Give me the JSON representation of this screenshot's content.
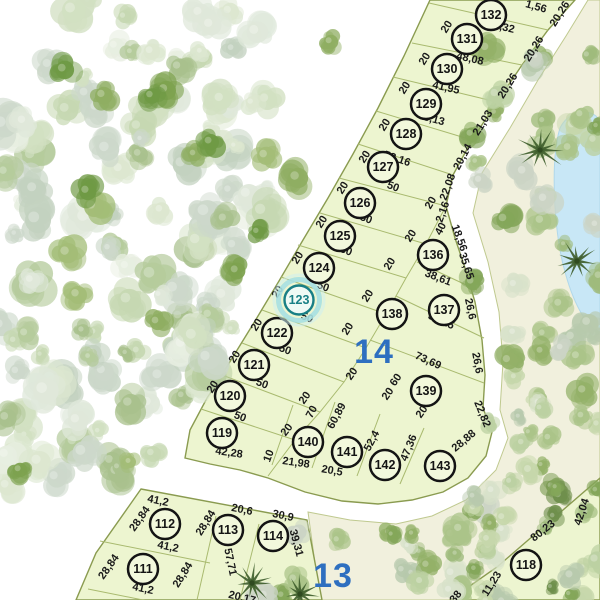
{
  "map": {
    "type": "subdivision-plan",
    "selected_lot": "123",
    "blocks": [
      {
        "label": "14",
        "x": 374,
        "y": 352
      },
      {
        "label": "13",
        "x": 333,
        "y": 576
      }
    ],
    "lots": [
      {
        "num": "111",
        "x": 143,
        "y": 569
      },
      {
        "num": "112",
        "x": 165,
        "y": 524
      },
      {
        "num": "113",
        "x": 228,
        "y": 530
      },
      {
        "num": "114",
        "x": 273,
        "y": 536
      },
      {
        "num": "118",
        "x": 526,
        "y": 565
      },
      {
        "num": "119",
        "x": 222,
        "y": 433
      },
      {
        "num": "120",
        "x": 230,
        "y": 396
      },
      {
        "num": "121",
        "x": 254,
        "y": 365
      },
      {
        "num": "122",
        "x": 277,
        "y": 333
      },
      {
        "num": "123",
        "x": 299,
        "y": 300,
        "selected": true
      },
      {
        "num": "124",
        "x": 319,
        "y": 268
      },
      {
        "num": "125",
        "x": 340,
        "y": 236
      },
      {
        "num": "126",
        "x": 360,
        "y": 203
      },
      {
        "num": "127",
        "x": 383,
        "y": 167
      },
      {
        "num": "128",
        "x": 406,
        "y": 134
      },
      {
        "num": "129",
        "x": 426,
        "y": 104
      },
      {
        "num": "130",
        "x": 447,
        "y": 69
      },
      {
        "num": "131",
        "x": 467,
        "y": 39
      },
      {
        "num": "132",
        "x": 491,
        "y": 15
      },
      {
        "num": "136",
        "x": 433,
        "y": 255
      },
      {
        "num": "137",
        "x": 444,
        "y": 310
      },
      {
        "num": "138",
        "x": 392,
        "y": 314
      },
      {
        "num": "139",
        "x": 426,
        "y": 391
      },
      {
        "num": "140",
        "x": 308,
        "y": 442
      },
      {
        "num": "141",
        "x": 347,
        "y": 452
      },
      {
        "num": "142",
        "x": 385,
        "y": 465
      },
      {
        "num": "143",
        "x": 440,
        "y": 466
      }
    ],
    "dimensions": [
      {
        "text": "1,56",
        "x": 536,
        "y": 7,
        "rot": 16
      },
      {
        "text": "51,32",
        "x": 501,
        "y": 27,
        "rot": 13
      },
      {
        "text": "48,08",
        "x": 470,
        "y": 59,
        "rot": 13
      },
      {
        "text": "41,95",
        "x": 446,
        "y": 88,
        "rot": 13
      },
      {
        "text": "43,13",
        "x": 431,
        "y": 119,
        "rot": 15
      },
      {
        "text": "52,16",
        "x": 397,
        "y": 159,
        "rot": 19
      },
      {
        "text": "50",
        "x": 393,
        "y": 187,
        "rot": 21
      },
      {
        "text": "50",
        "x": 366,
        "y": 219,
        "rot": 21
      },
      {
        "text": "50",
        "x": 346,
        "y": 251,
        "rot": 21
      },
      {
        "text": "50",
        "x": 323,
        "y": 287,
        "rot": 21
      },
      {
        "text": "50",
        "x": 307,
        "y": 318,
        "rot": 21
      },
      {
        "text": "50",
        "x": 285,
        "y": 350,
        "rot": 21
      },
      {
        "text": "50",
        "x": 262,
        "y": 384,
        "rot": 21
      },
      {
        "text": "50",
        "x": 240,
        "y": 417,
        "rot": 21
      },
      {
        "text": "42,28",
        "x": 229,
        "y": 453,
        "rot": 8
      },
      {
        "text": "20,26",
        "x": 560,
        "y": 14,
        "rot": -58
      },
      {
        "text": "20,26",
        "x": 534,
        "y": 49,
        "rot": -58
      },
      {
        "text": "20,26",
        "x": 508,
        "y": 86,
        "rot": -58
      },
      {
        "text": "21,03",
        "x": 483,
        "y": 123,
        "rot": -58
      },
      {
        "text": "20,14",
        "x": 463,
        "y": 157,
        "rot": -62
      },
      {
        "text": "22,08",
        "x": 448,
        "y": 187,
        "rot": -70
      },
      {
        "text": "2,16",
        "x": 443,
        "y": 212,
        "rot": -70
      },
      {
        "text": "18,56",
        "x": 459,
        "y": 238,
        "rot": 70
      },
      {
        "text": "35,65",
        "x": 466,
        "y": 266,
        "rot": 72
      },
      {
        "text": "26,6",
        "x": 470,
        "y": 309,
        "rot": 78
      },
      {
        "text": "26,6",
        "x": 477,
        "y": 363,
        "rot": 80
      },
      {
        "text": "22,82",
        "x": 482,
        "y": 414,
        "rot": 68
      },
      {
        "text": "28,88",
        "x": 464,
        "y": 441,
        "rot": -40
      },
      {
        "text": "20",
        "x": 447,
        "y": 27,
        "rot": -58
      },
      {
        "text": "20",
        "x": 425,
        "y": 59,
        "rot": -58
      },
      {
        "text": "20",
        "x": 405,
        "y": 88,
        "rot": -58
      },
      {
        "text": "20",
        "x": 385,
        "y": 125,
        "rot": -58
      },
      {
        "text": "20",
        "x": 365,
        "y": 157,
        "rot": -58
      },
      {
        "text": "20",
        "x": 343,
        "y": 188,
        "rot": -58
      },
      {
        "text": "20",
        "x": 322,
        "y": 222,
        "rot": -58
      },
      {
        "text": "20",
        "x": 298,
        "y": 258,
        "rot": -58
      },
      {
        "text": "20",
        "x": 278,
        "y": 292,
        "rot": -58
      },
      {
        "text": "20",
        "x": 257,
        "y": 325,
        "rot": -58
      },
      {
        "text": "20",
        "x": 235,
        "y": 357,
        "rot": -58
      },
      {
        "text": "20",
        "x": 213,
        "y": 387,
        "rot": -58
      },
      {
        "text": "20",
        "x": 431,
        "y": 203,
        "rot": -60
      },
      {
        "text": "40",
        "x": 441,
        "y": 229,
        "rot": -62
      },
      {
        "text": "20",
        "x": 411,
        "y": 236,
        "rot": -58
      },
      {
        "text": "20",
        "x": 390,
        "y": 264,
        "rot": -58
      },
      {
        "text": "20",
        "x": 368,
        "y": 296,
        "rot": -58
      },
      {
        "text": "20",
        "x": 348,
        "y": 329,
        "rot": -58
      },
      {
        "text": "38,61",
        "x": 438,
        "y": 278,
        "rot": 21
      },
      {
        "text": "56,15",
        "x": 441,
        "y": 321,
        "rot": 24
      },
      {
        "text": "73,69",
        "x": 428,
        "y": 361,
        "rot": 24
      },
      {
        "text": "60",
        "x": 396,
        "y": 380,
        "rot": -55
      },
      {
        "text": "20",
        "x": 388,
        "y": 394,
        "rot": -55
      },
      {
        "text": "20",
        "x": 352,
        "y": 374,
        "rot": -55
      },
      {
        "text": "20",
        "x": 422,
        "y": 412,
        "rot": -55
      },
      {
        "text": "20",
        "x": 305,
        "y": 398,
        "rot": -55
      },
      {
        "text": "20",
        "x": 287,
        "y": 430,
        "rot": -52
      },
      {
        "text": "70",
        "x": 312,
        "y": 412,
        "rot": -62
      },
      {
        "text": "60,89",
        "x": 337,
        "y": 416,
        "rot": -62
      },
      {
        "text": "52,4",
        "x": 372,
        "y": 441,
        "rot": -62
      },
      {
        "text": "47,36",
        "x": 409,
        "y": 448,
        "rot": -68
      },
      {
        "text": "10",
        "x": 269,
        "y": 456,
        "rot": -70
      },
      {
        "text": "21,98",
        "x": 296,
        "y": 463,
        "rot": 8
      },
      {
        "text": "20,5",
        "x": 332,
        "y": 471,
        "rot": 10
      },
      {
        "text": "41,2",
        "x": 158,
        "y": 501,
        "rot": 12
      },
      {
        "text": "20,6",
        "x": 242,
        "y": 510,
        "rot": 12
      },
      {
        "text": "30,9",
        "x": 283,
        "y": 516,
        "rot": 12
      },
      {
        "text": "28,84",
        "x": 140,
        "y": 519,
        "rot": -55
      },
      {
        "text": "28,84",
        "x": 206,
        "y": 523,
        "rot": -58
      },
      {
        "text": "41,2",
        "x": 168,
        "y": 547,
        "rot": 12
      },
      {
        "text": "28,84",
        "x": 109,
        "y": 567,
        "rot": -55
      },
      {
        "text": "28,84",
        "x": 183,
        "y": 575,
        "rot": -58
      },
      {
        "text": "41,2",
        "x": 143,
        "y": 589,
        "rot": 12
      },
      {
        "text": "57,71",
        "x": 230,
        "y": 562,
        "rot": 78
      },
      {
        "text": "39,31",
        "x": 296,
        "y": 543,
        "rot": 75
      },
      {
        "text": "20,17",
        "x": 242,
        "y": 598,
        "rot": 14
      },
      {
        "text": "80,23",
        "x": 543,
        "y": 531,
        "rot": -38
      },
      {
        "text": "42,04",
        "x": 582,
        "y": 512,
        "rot": -72
      },
      {
        "text": "11,23",
        "x": 492,
        "y": 584,
        "rot": -58
      },
      {
        "text": "38",
        "x": 456,
        "y": 597,
        "rot": -50
      }
    ],
    "colors": {
      "lot_fill": "#edf5d0",
      "lot_line": "#a9ba6f",
      "block_outline": "#8a9b50",
      "street": "#ffffff",
      "park": "#f1f0dd",
      "park_edge": "#bfc98f",
      "water": "#c8e7f6",
      "dim_text": "#1a1a1a",
      "marker_ring": "#141414",
      "marker_fill": "#f2f8dc",
      "selected_ring": "#187f85",
      "selected_halo": "#a6e0e2",
      "selected_halo_outer": "#cdeff0",
      "selected_fill": "#effaf5",
      "block_label": "#2e6fc0",
      "palm": "#3f5e2d"
    },
    "icons": [
      {
        "name": "palm-tree-icon"
      },
      {
        "name": "tree-icon"
      },
      {
        "name": "pond-water"
      }
    ]
  }
}
